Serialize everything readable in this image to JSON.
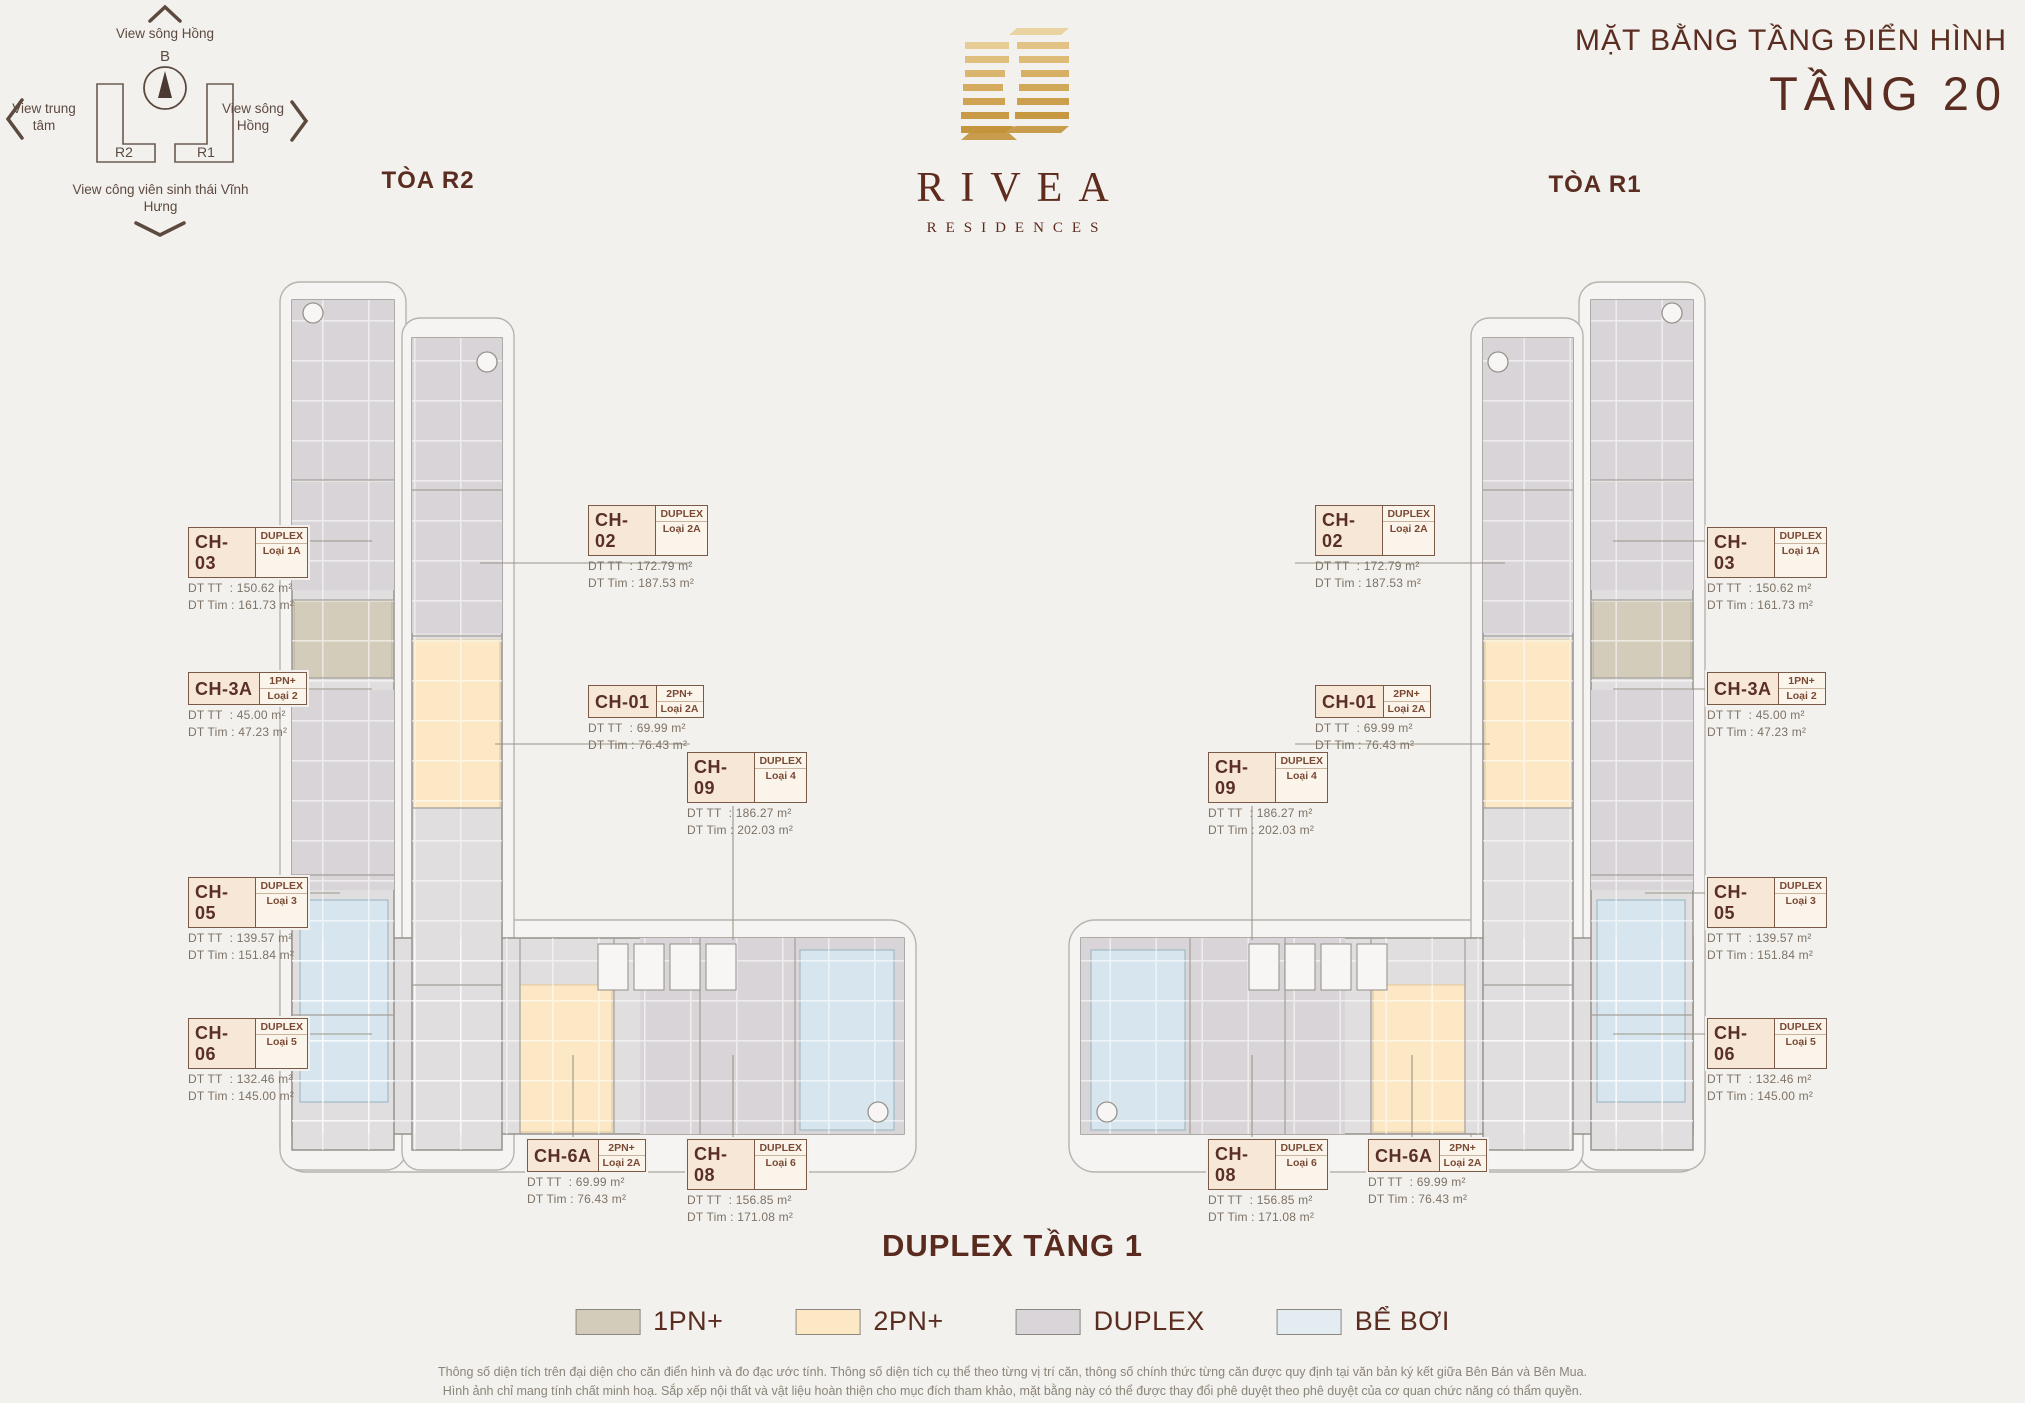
{
  "header": {
    "title_line1": "MẶT BẰNG TẦNG ĐIỂN HÌNH",
    "title_line2": "TẦNG 20",
    "tower_left": "TÒA R2",
    "tower_right": "TÒA R1"
  },
  "logo": {
    "name": "RIVEA",
    "subtitle": "RESIDENCES"
  },
  "compass": {
    "north": "B",
    "view_top": "View sông Hồng",
    "view_left": "View trung tâm",
    "view_right": "View sông Hồng",
    "view_bottom": "View công viên sinh thái Vĩnh Hưng",
    "block_left": "R2",
    "block_right": "R1"
  },
  "area_prefix": {
    "tt": "DT TT",
    "tim": "DT Tim"
  },
  "units": {
    "r2": [
      {
        "code": "CH-03",
        "type": "DUPLEX",
        "loai": "Loại 1A",
        "dt_tt": "150.62 m²",
        "dt_tim": "161.73 m²"
      },
      {
        "code": "CH-3A",
        "type": "1PN+",
        "loai": "Loại 2",
        "dt_tt": "45.00 m²",
        "dt_tim": "47.23 m²"
      },
      {
        "code": "CH-05",
        "type": "DUPLEX",
        "loai": "Loại 3",
        "dt_tt": "139.57 m²",
        "dt_tim": "151.84 m²"
      },
      {
        "code": "CH-06",
        "type": "DUPLEX",
        "loai": "Loại 5",
        "dt_tt": "132.46 m²",
        "dt_tim": "145.00 m²"
      },
      {
        "code": "CH-02",
        "type": "DUPLEX",
        "loai": "Loại 2A",
        "dt_tt": "172.79 m²",
        "dt_tim": "187.53 m²"
      },
      {
        "code": "CH-01",
        "type": "2PN+",
        "loai": "Loại 2A",
        "dt_tt": "69.99 m²",
        "dt_tim": "76.43 m²"
      },
      {
        "code": "CH-09",
        "type": "DUPLEX",
        "loai": "Loại 4",
        "dt_tt": "186.27 m²",
        "dt_tim": "202.03 m²"
      },
      {
        "code": "CH-6A",
        "type": "2PN+",
        "loai": "Loại 2A",
        "dt_tt": "69.99 m²",
        "dt_tim": "76.43 m²"
      },
      {
        "code": "CH-08",
        "type": "DUPLEX",
        "loai": "Loại 6",
        "dt_tt": "156.85 m²",
        "dt_tim": "171.08 m²"
      }
    ],
    "r1": [
      {
        "code": "CH-02",
        "type": "DUPLEX",
        "loai": "Loại 2A",
        "dt_tt": "172.79 m²",
        "dt_tim": "187.53 m²"
      },
      {
        "code": "CH-01",
        "type": "2PN+",
        "loai": "Loại 2A",
        "dt_tt": "69.99 m²",
        "dt_tim": "76.43 m²"
      },
      {
        "code": "CH-09",
        "type": "DUPLEX",
        "loai": "Loại 4",
        "dt_tt": "186.27 m²",
        "dt_tim": "202.03 m²"
      },
      {
        "code": "CH-03",
        "type": "DUPLEX",
        "loai": "Loại 1A",
        "dt_tt": "150.62 m²",
        "dt_tim": "161.73 m²"
      },
      {
        "code": "CH-3A",
        "type": "1PN+",
        "loai": "Loại 2",
        "dt_tt": "45.00 m²",
        "dt_tim": "47.23 m²"
      },
      {
        "code": "CH-05",
        "type": "DUPLEX",
        "loai": "Loại 3",
        "dt_tt": "139.57 m²",
        "dt_tim": "151.84 m²"
      },
      {
        "code": "CH-06",
        "type": "DUPLEX",
        "loai": "Loại 5",
        "dt_tt": "132.46 m²",
        "dt_tim": "145.00 m²"
      },
      {
        "code": "CH-08",
        "type": "DUPLEX",
        "loai": "Loại 6",
        "dt_tt": "156.85 m²",
        "dt_tim": "171.08 m²"
      },
      {
        "code": "CH-6A",
        "type": "2PN+",
        "loai": "Loại 2A",
        "dt_tt": "69.99 m²",
        "dt_tim": "76.43 m²"
      }
    ]
  },
  "footer": {
    "subtitle": "DUPLEX TẦNG 1",
    "legend": [
      {
        "label": "1PN+",
        "color": "#d4ccba"
      },
      {
        "label": "2PN+",
        "color": "#fce8c4"
      },
      {
        "label": "DUPLEX",
        "color": "#dad5d8"
      },
      {
        "label": "BỂ BƠI",
        "color": "#e2ecf1"
      }
    ],
    "disclaimer_line1": "Thông số diện tích trên đại diện cho căn điển hình và đo đạc ước tính. Thông số diện tích cụ thể theo từng vị trí căn, thông số chính thức từng căn được quy định tại văn bản ký kết giữa Bên Bán và Bên Mua.",
    "disclaimer_line2": "Hình ảnh chỉ mang tính chất minh hoạ. Sắp xếp nội thất và vật liệu hoàn thiện cho mục đích tham khảo, mặt bằng này có thể được thay đổi phê duyệt theo phê duyệt của cơ quan chức năng có thẩm quyền."
  }
}
